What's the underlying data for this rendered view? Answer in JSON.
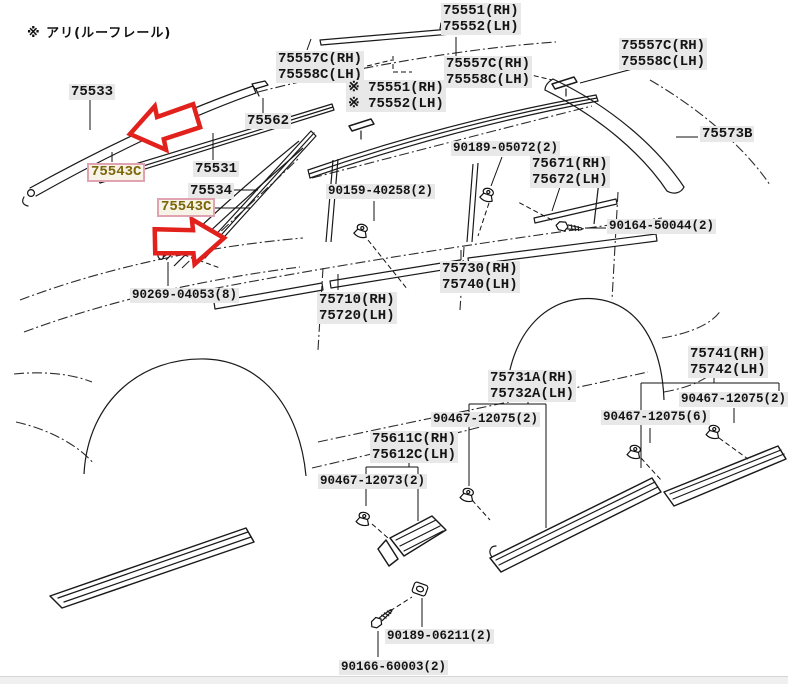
{
  "page": {
    "note": "※ アリ(ルーフレール)"
  },
  "colors": {
    "line": "#1a1a1a",
    "label_bg": "#e8e8e8",
    "highlight_text": "#7c660a",
    "highlight_bg": "#f8f3e7",
    "highlight_border": "#dfa3b2",
    "arrow_red": "#e2211c",
    "page_bg": "#ffffff"
  },
  "icons": [
    {
      "name": "highlight-arrow-left-icon",
      "meaning": "red outline arrow pointing left at part 75543C"
    },
    {
      "name": "highlight-arrow-right-icon",
      "meaning": "red outline arrow pointing right at part 75543C"
    },
    {
      "name": "clip-icon",
      "meaning": "push clip fastener"
    },
    {
      "name": "screw-icon",
      "meaning": "screw fastener"
    },
    {
      "name": "rivet-icon",
      "meaning": "rivet fastener"
    },
    {
      "name": "washer-clip-icon",
      "meaning": "plate clip fastener"
    }
  ],
  "labels": [
    {
      "id": "75551-75552-roof",
      "type": "part",
      "x": 441,
      "y": 3,
      "lines": [
        "75551(RH)",
        "75552(LH)"
      ]
    },
    {
      "id": "75557c-75558c-left",
      "type": "part",
      "x": 276,
      "y": 51,
      "lines": [
        "75557C(RH)",
        "75558C(LH)"
      ]
    },
    {
      "id": "75557c-75558c-mid",
      "type": "part",
      "x": 444,
      "y": 56,
      "lines": [
        "75557C(RH)",
        "75558C(LH)"
      ]
    },
    {
      "id": "75551-75552-roofrail",
      "type": "part",
      "x": 346,
      "y": 80,
      "lines": [
        "※ 75551(RH)",
        "※ 75552(LH)"
      ]
    },
    {
      "id": "75557c-75558c-right",
      "type": "part",
      "x": 619,
      "y": 38,
      "lines": [
        "75557C(RH)",
        "75558C(LH)"
      ]
    },
    {
      "id": "75573b",
      "type": "part",
      "x": 700,
      "y": 126,
      "lines": [
        "75573B"
      ]
    },
    {
      "id": "75533",
      "type": "part",
      "x": 69,
      "y": 84,
      "lines": [
        "75533"
      ]
    },
    {
      "id": "75543c-upper",
      "type": "hl",
      "x": 87,
      "y": 163,
      "lines": [
        "75543C"
      ]
    },
    {
      "id": "75562",
      "type": "part",
      "x": 245,
      "y": 113,
      "lines": [
        "75562"
      ]
    },
    {
      "id": "75531",
      "type": "part",
      "x": 193,
      "y": 161,
      "lines": [
        "75531"
      ]
    },
    {
      "id": "75534",
      "type": "part",
      "x": 188,
      "y": 183,
      "lines": [
        "75534"
      ]
    },
    {
      "id": "75543c-lower",
      "type": "hl",
      "x": 157,
      "y": 198,
      "lines": [
        "75543C"
      ]
    },
    {
      "id": "90189-05072",
      "type": "fastlbl",
      "x": 451,
      "y": 141,
      "lines": [
        "90189-05072(2)"
      ]
    },
    {
      "id": "75671-75672",
      "type": "part",
      "x": 530,
      "y": 156,
      "lines": [
        "75671(RH)",
        "75672(LH)"
      ]
    },
    {
      "id": "90159-40258",
      "type": "fastlbl",
      "x": 326,
      "y": 184,
      "lines": [
        "90159-40258(2)"
      ]
    },
    {
      "id": "90164-50044",
      "type": "fastlbl",
      "x": 607,
      "y": 219,
      "lines": [
        "90164-50044(2)"
      ]
    },
    {
      "id": "90269-04053",
      "type": "fastlbl",
      "x": 130,
      "y": 288,
      "lines": [
        "90269-04053(8)"
      ]
    },
    {
      "id": "75730-75740",
      "type": "part",
      "x": 440,
      "y": 261,
      "lines": [
        "75730(RH)",
        "75740(LH)"
      ]
    },
    {
      "id": "75710-75720",
      "type": "part",
      "x": 317,
      "y": 292,
      "lines": [
        "75710(RH)",
        "75720(LH)"
      ]
    },
    {
      "id": "75741-75742",
      "type": "part",
      "x": 688,
      "y": 346,
      "lines": [
        "75741(RH)",
        "75742(LH)"
      ]
    },
    {
      "id": "90467-12075-right",
      "type": "fastlbl",
      "x": 679,
      "y": 392,
      "lines": [
        "90467-12075(2)"
      ]
    },
    {
      "id": "90467-12075-six",
      "type": "fastlbl",
      "x": 601,
      "y": 410,
      "lines": [
        "90467-12075(6)"
      ]
    },
    {
      "id": "75731a-75732a",
      "type": "part",
      "x": 488,
      "y": 370,
      "lines": [
        "75731A(RH)",
        "75732A(LH)"
      ]
    },
    {
      "id": "90467-12075-mid",
      "type": "fastlbl",
      "x": 431,
      "y": 412,
      "lines": [
        "90467-12075(2)"
      ]
    },
    {
      "id": "75611c-75612c",
      "type": "part",
      "x": 370,
      "y": 431,
      "lines": [
        "75611C(RH)",
        "75612C(LH)"
      ]
    },
    {
      "id": "90467-12073",
      "type": "fastlbl",
      "x": 318,
      "y": 474,
      "lines": [
        "90467-12073(2)"
      ]
    },
    {
      "id": "90189-06211",
      "type": "fastlbl",
      "x": 385,
      "y": 629,
      "lines": [
        "90189-06211(2)"
      ]
    },
    {
      "id": "90166-60003",
      "type": "fastlbl",
      "x": 339,
      "y": 660,
      "lines": [
        "90166-60003(2)"
      ]
    }
  ]
}
